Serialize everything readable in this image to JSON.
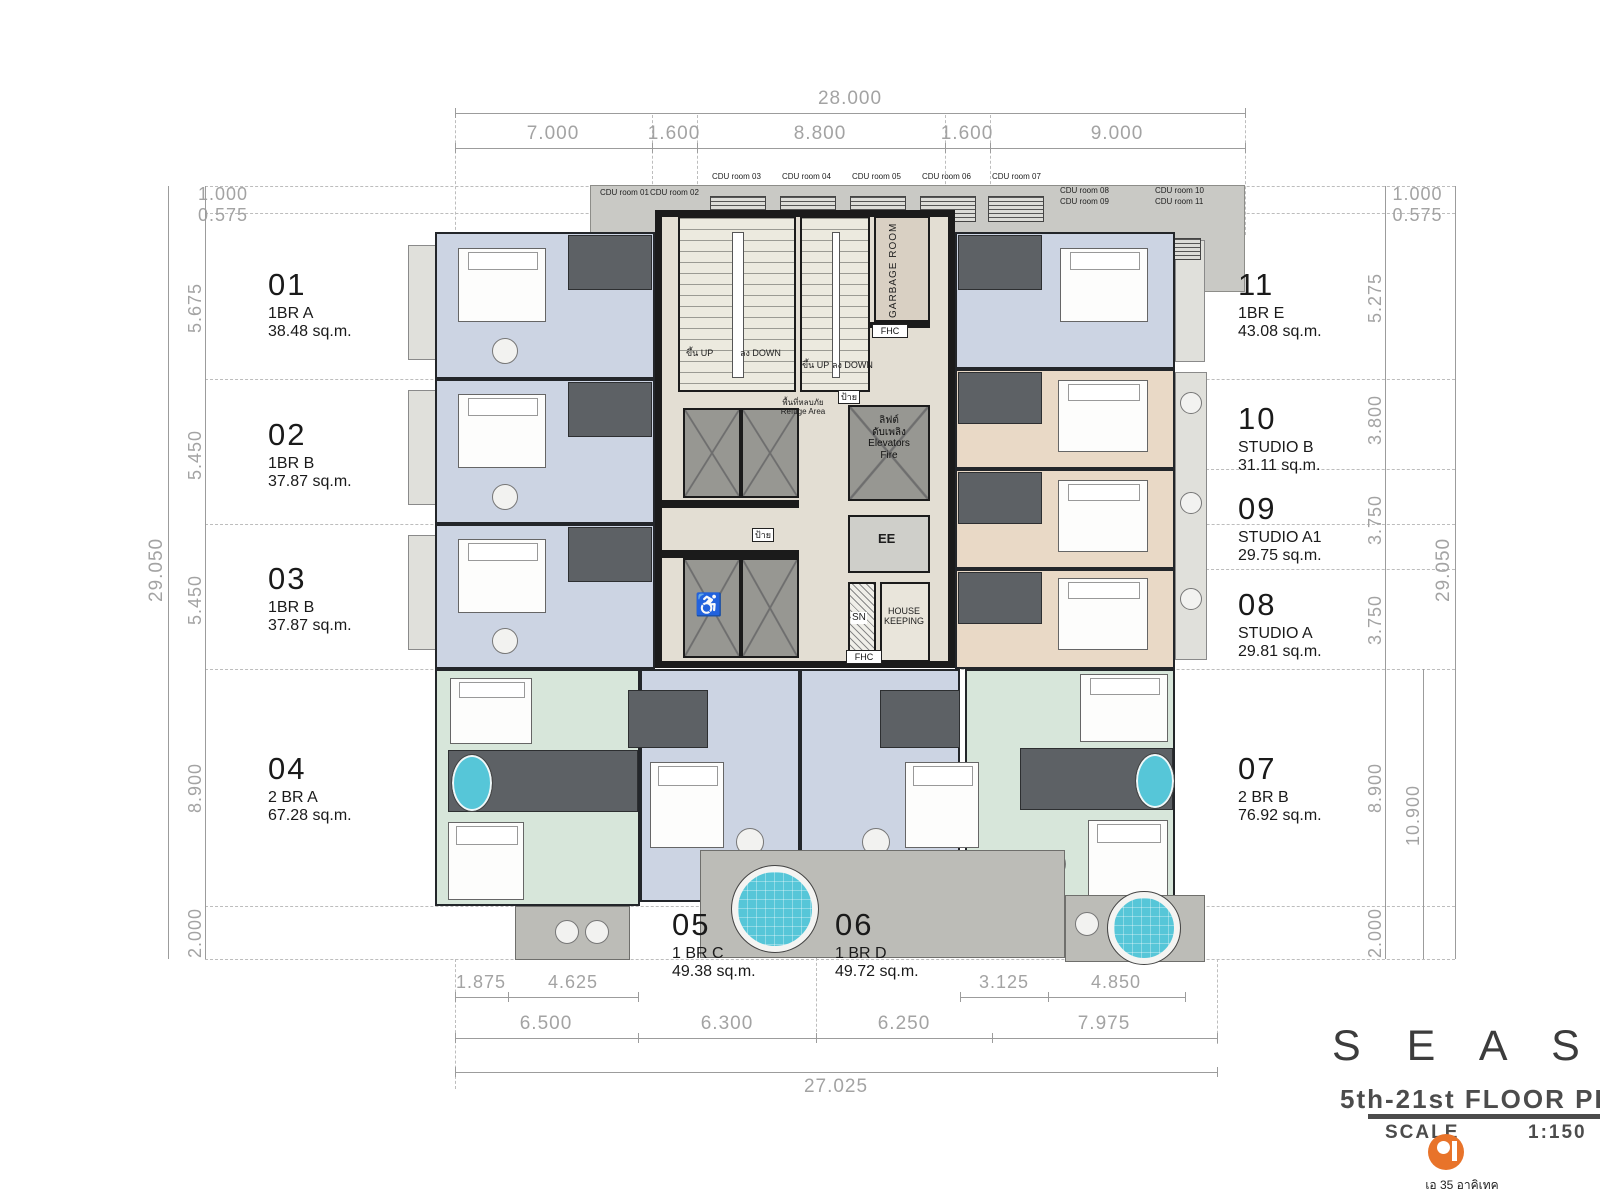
{
  "title_block": {
    "project": "S E A  S P I R E",
    "plan": "5th-21st FLOOR PLAN",
    "scale_label": "SCALE",
    "scale_value": "1:150",
    "firm": "เอ 35 อาคิเทค"
  },
  "units": [
    {
      "no": "01",
      "type": "1BR A",
      "area": "38.48 sq.m."
    },
    {
      "no": "02",
      "type": "1BR B",
      "area": "37.87 sq.m."
    },
    {
      "no": "03",
      "type": "1BR B",
      "area": "37.87 sq.m."
    },
    {
      "no": "04",
      "type": "2 BR A",
      "area": "67.28 sq.m."
    },
    {
      "no": "05",
      "type": "1 BR C",
      "area": "49.38 sq.m."
    },
    {
      "no": "06",
      "type": "1 BR D",
      "area": "49.72 sq.m."
    },
    {
      "no": "07",
      "type": "2 BR B",
      "area": "76.92 sq.m."
    },
    {
      "no": "08",
      "type": "STUDIO A",
      "area": "29.81 sq.m."
    },
    {
      "no": "09",
      "type": "STUDIO A1",
      "area": "29.75 sq.m."
    },
    {
      "no": "10",
      "type": "STUDIO B",
      "area": "31.11 sq.m."
    },
    {
      "no": "11",
      "type": "1BR E",
      "area": "43.08 sq.m."
    }
  ],
  "cdu_rooms": [
    "CDU room 01",
    "CDU room 02",
    "CDU room 03",
    "CDU room 04",
    "CDU room 05",
    "CDU room 06",
    "CDU room 07",
    "CDU room 08",
    "CDU room 09",
    "CDU room 10",
    "CDU room 11"
  ],
  "core": {
    "stair_up": "ขึ้น UP",
    "stair_down": "ลง DOWN",
    "garbage": "GARBAGE ROOM",
    "elev_fire_th1": "ลิฟต์",
    "elev_fire_th2": "ดับเพลิง",
    "elev_fire_en1": "Elevators",
    "elev_fire_en2": "Fire",
    "ee": "EE",
    "sn": "SN",
    "housekeeping_1": "HOUSE",
    "housekeeping_2": "KEEPING",
    "fhc": "FHC",
    "refuge_th": "พื้นที่หลบภัย",
    "refuge_en": "Refuge Area",
    "sign": "ป้าย",
    "accessible_icon": "♿"
  },
  "dimensions": {
    "top": {
      "overall": "28.000",
      "segments": [
        "7.000",
        "1.600",
        "8.800",
        "1.600",
        "9.000"
      ]
    },
    "left": {
      "overall": "29.050",
      "offset1": "1.000",
      "offset2": "0.575",
      "segments": [
        "5.675",
        "5.450",
        "5.450",
        "8.900",
        "2.000"
      ]
    },
    "right": {
      "overall": "29.050",
      "offset1": "1.000",
      "offset2": "0.575",
      "segments": [
        "5.275",
        "3.800",
        "3.750",
        "3.750",
        "8.900",
        "2.000"
      ],
      "lower_total": "10.900"
    },
    "bottom": {
      "row1": [
        "1.875",
        "4.625",
        "3.125",
        "4.850"
      ],
      "row2": [
        "6.500",
        "6.300",
        "6.250",
        "7.975"
      ],
      "overall": "27.025"
    }
  },
  "colors": {
    "one_bedroom": "#ccd4e3",
    "studio": "#e9d9c6",
    "two_bedroom": "#d7e6da",
    "accent_logo": "#e8732a",
    "water": "#56c6d8"
  }
}
